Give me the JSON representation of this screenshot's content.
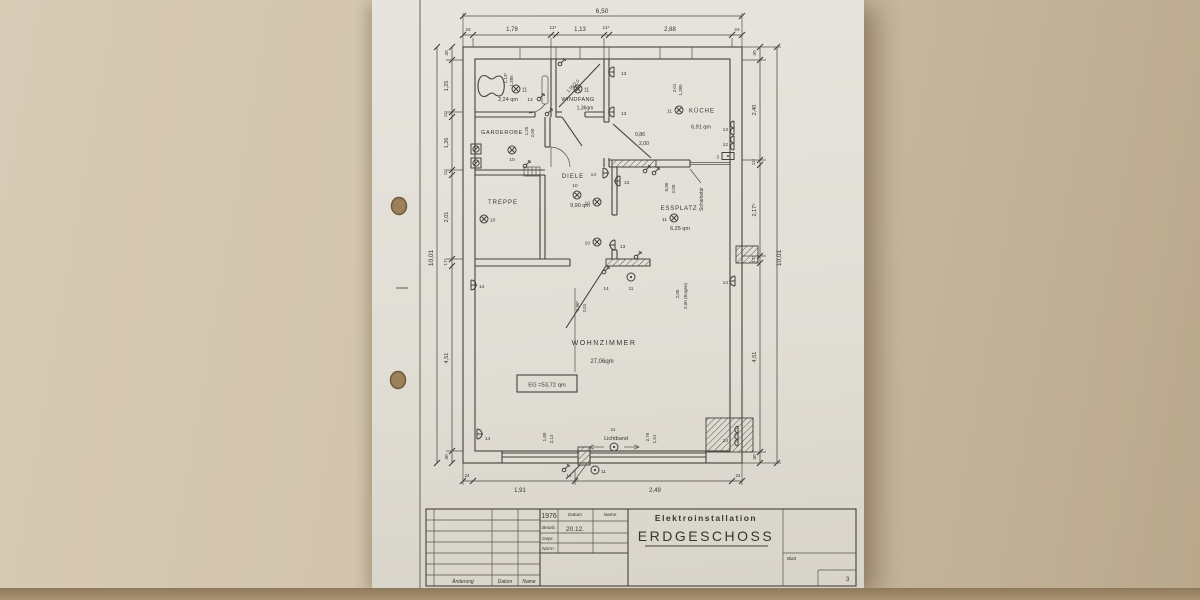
{
  "dims": {
    "overall_w": "6,50",
    "overall_h": "10,01",
    "top": [
      "24",
      "1,78",
      "11⁵",
      "1,13",
      "11⁵",
      "2,88",
      "24"
    ],
    "left": [
      "30",
      "1,25",
      "11⁵",
      "1,26",
      "11⁵",
      "2,01",
      "17⁵",
      "4,51",
      "30"
    ],
    "right": [
      "30",
      "2,40",
      "11⁵",
      "2,17⁵",
      "17⁵",
      "4,51",
      "30"
    ],
    "bottom": [
      "24",
      "1,91",
      "2,49",
      "24"
    ],
    "wc_window": [
      "1,13⁵",
      "1,385"
    ],
    "kueche_window": [
      "2,01",
      "1,385"
    ],
    "garderobe": [
      "1,25",
      "2,00"
    ],
    "windfang_door": "1,05/2,0",
    "kueche_door": [
      "0,86",
      "2,00"
    ],
    "essplatz_door": [
      "0,86",
      "2,00"
    ],
    "wohnzimmer_door": [
      "0,86⁵",
      "2,01"
    ],
    "bogen": [
      "2,00",
      "2,00 (Bogen)"
    ],
    "window_left": [
      "1,80",
      "2,13"
    ],
    "window_right": [
      "2,76",
      "1,51"
    ]
  },
  "rooms": {
    "wc_area": "2,24 qm",
    "windfang": "WINDFANG",
    "windfang_area": "1,36qm",
    "kueche": "KÜCHE",
    "kueche_area": "6,91 qm",
    "garderobe": "GARDEROBE",
    "treppe": "TREPPE",
    "diele": "DIELE",
    "diele_area": "9,90 qm",
    "essplatz": "ESSPLATZ",
    "essplatz_area": "6,25 qm",
    "wohnzimmer": "WOHNZIMMER",
    "wohnzimmer_area": "27,06qm",
    "eg_total": "EG =53,72 qm",
    "schiebetuer": "Schiebetür",
    "lichtband": "Lichtband"
  },
  "sym": {
    "n3": "3",
    "n10": "10",
    "n11": "11",
    "n12": "12",
    "n13": "13",
    "n14": "14"
  },
  "titleblock": {
    "year": "1976",
    "col_datum": "Datum",
    "col_name": "Name",
    "bearb": "Bearb.",
    "bearb_datum": "20.12.",
    "gepr": "Gepr.",
    "norm": "Norm",
    "project": "Elektroinstallation",
    "title": "ERDGESCHOSS",
    "aenderung": "Änderung",
    "datum": "Datum",
    "name": "Name",
    "blatt": "Blatt",
    "blatt_no": "3"
  }
}
